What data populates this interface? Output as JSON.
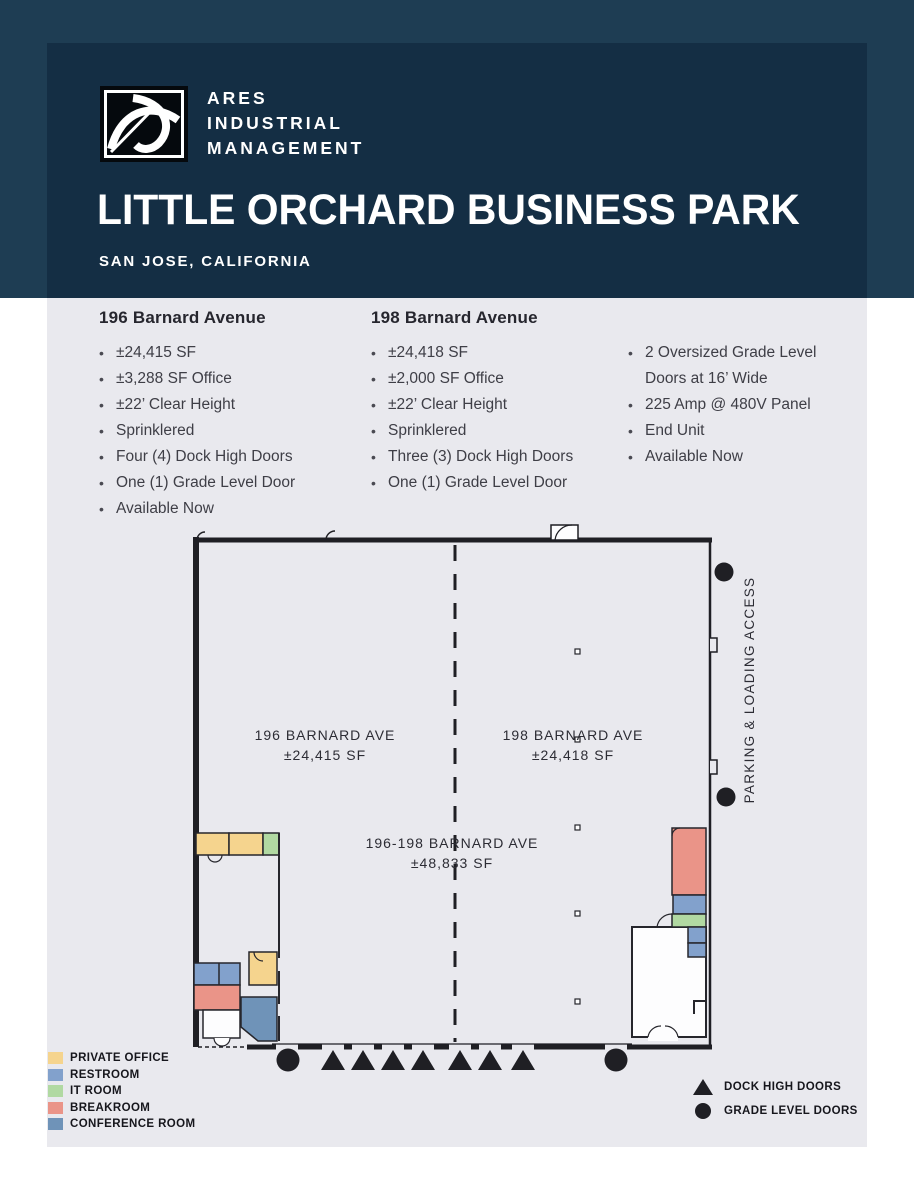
{
  "header": {
    "brand": [
      "ARES",
      "INDUSTRIAL",
      "MANAGEMENT"
    ],
    "title": "LITTLE ORCHARD BUSINESS PARK",
    "subtitle": "SAN JOSE, CALIFORNIA",
    "band_color": "#1e3d53",
    "panel_color": "#142e44"
  },
  "specs": {
    "unit196": {
      "heading": "196 Barnard Avenue",
      "items": [
        "±24,415 SF",
        "±3,288 SF Office",
        "±22’ Clear Height",
        "Sprinklered",
        "Four (4) Dock High Doors",
        "One (1) Grade Level Door",
        "Available Now"
      ]
    },
    "unit198": {
      "heading": "198 Barnard Avenue",
      "items": [
        "±24,418 SF",
        "±2,000 SF Office",
        "±22’ Clear Height",
        "Sprinklered",
        "Three (3) Dock High Doors",
        "One (1) Grade Level Door"
      ]
    },
    "features": {
      "items": [
        "2 Oversized Grade Level Doors at 16’ Wide",
        "225 Amp @ 480V Panel",
        "End Unit",
        "Available Now"
      ]
    }
  },
  "floorplan": {
    "unit196_label": {
      "line1": "196 BARNARD AVE",
      "line2": "±24,415 SF"
    },
    "unit198_label": {
      "line1": "198 BARNARD AVE",
      "line2": "±24,418 SF"
    },
    "combined_label": {
      "line1": "196-198 BARNARD AVE",
      "line2": "±48,833 SF"
    },
    "parking_label": "PARKING & LOADING ACCESS"
  },
  "legend": {
    "rooms": [
      {
        "label": "PRIVATE OFFICE",
        "color": "#f5d48e"
      },
      {
        "label": "RESTROOM",
        "color": "#82a1cc"
      },
      {
        "label": "IT ROOM",
        "color": "#b1d9a2"
      },
      {
        "label": "BREAKROOM",
        "color": "#ea9488"
      },
      {
        "label": "CONFERENCE ROOM",
        "color": "#6f93b8"
      }
    ],
    "symbols": [
      {
        "label": "DOCK HIGH DOORS",
        "icon": "dock-high-triangle-icon"
      },
      {
        "label": "GRADE LEVEL DOORS",
        "icon": "grade-level-circle-icon"
      }
    ],
    "symbol_color": "#1f1f24"
  }
}
